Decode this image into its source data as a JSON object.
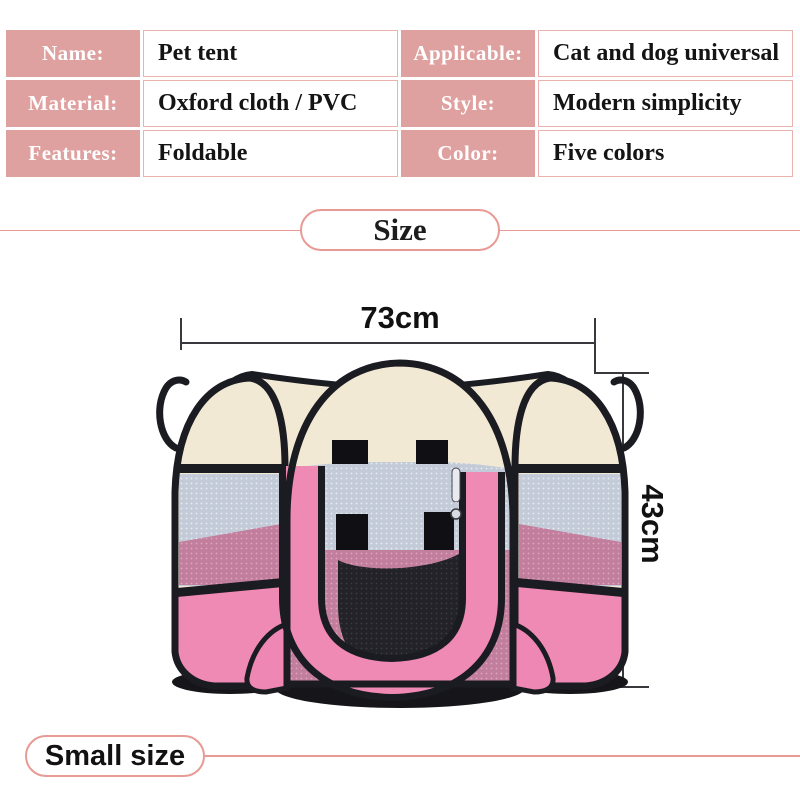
{
  "product": {
    "specs": [
      {
        "label": "Name:",
        "value": "Pet tent"
      },
      {
        "label": "Applicable:",
        "value": "Cat and dog universal"
      },
      {
        "label": "Material:",
        "value": "Oxford cloth / PVC"
      },
      {
        "label": "Style:",
        "value": "Modern simplicity"
      },
      {
        "label": "Features:",
        "value": "Foldable"
      },
      {
        "label": "Color:",
        "value": "Five colors"
      }
    ]
  },
  "size_section": {
    "title": "Size",
    "width_label": "73cm",
    "height_label": "43cm",
    "footer_label": "Small size"
  },
  "colors": {
    "accent_salmon": "#e89a94",
    "label_bg": "#dfa1a0",
    "dimension_line": "#38383d",
    "tent_pink": "#ef8ab5",
    "tent_cream": "#f2e9d4",
    "mesh_gray": "#c3cbd8",
    "trim_black": "#1b1b22"
  },
  "illustration": {
    "name": "pink foldable octagonal pet playpen photo"
  }
}
